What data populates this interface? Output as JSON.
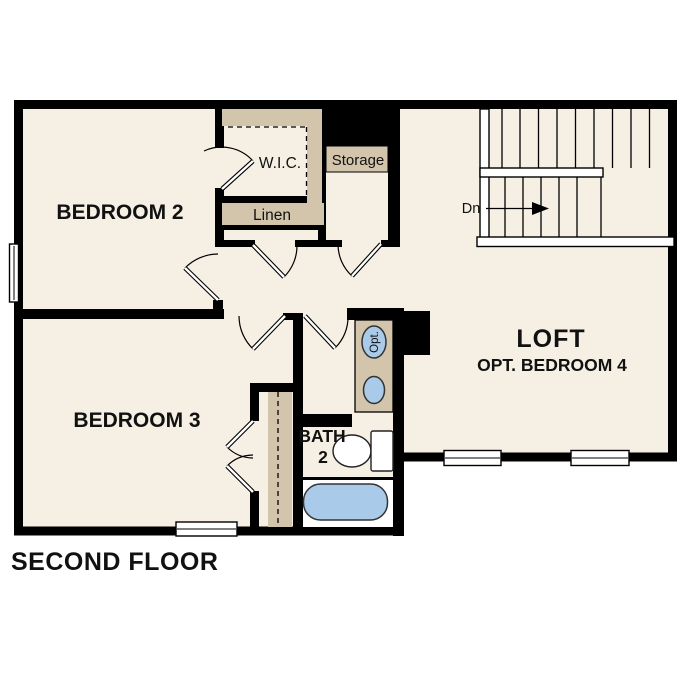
{
  "page_title": "SECOND FLOOR",
  "colors": {
    "floor": "#f6efe3",
    "shading": "#d2c5ab",
    "wall": "#000000",
    "fixture_blue": "#a9cae8",
    "text": "#111111"
  },
  "rooms": {
    "bedroom2": {
      "label": "BEDROOM 2"
    },
    "bedroom3": {
      "label": "BEDROOM 3"
    },
    "loft": {
      "label": "LOFT",
      "sublabel": "OPT. BEDROOM 4"
    },
    "bath": {
      "label_line1": "BATH",
      "label_line2": "2"
    },
    "wic": {
      "label": "W.I.C."
    },
    "linen": {
      "label": "Linen"
    },
    "storage": {
      "label": "Storage"
    }
  },
  "stairs": {
    "down_label": "Dn"
  },
  "fixtures": {
    "optional_label": "Opt."
  }
}
